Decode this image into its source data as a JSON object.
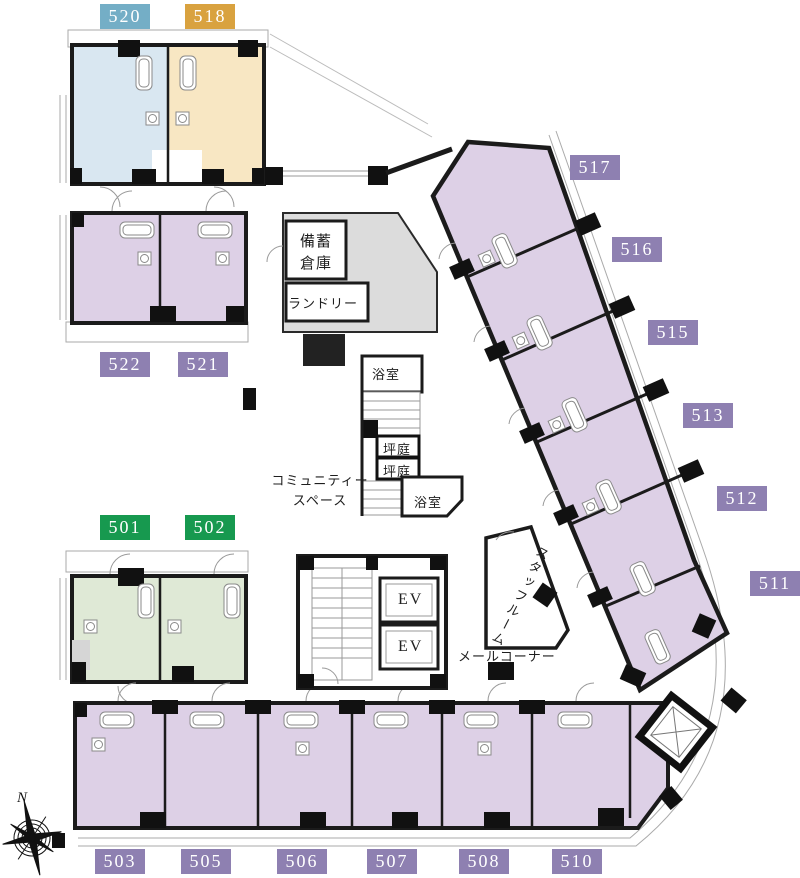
{
  "palette": {
    "blue": "#74aec6",
    "orange": "#d9a23f",
    "purple": "#8e80b1",
    "green": "#17994f",
    "room_blue": "#d9e7f1",
    "room_orange": "#f8e7c3",
    "room_purple": "#ddd0e6",
    "room_green": "#dfe9d6",
    "common_gray": "#dcdcdc",
    "wall": "#1b1b1b"
  },
  "badges": [
    {
      "label": "520",
      "color": "blue"
    },
    {
      "label": "518",
      "color": "orange"
    },
    {
      "label": "522",
      "color": "purple"
    },
    {
      "label": "521",
      "color": "purple"
    },
    {
      "label": "501",
      "color": "green"
    },
    {
      "label": "502",
      "color": "green"
    },
    {
      "label": "517",
      "color": "purple"
    },
    {
      "label": "516",
      "color": "purple"
    },
    {
      "label": "515",
      "color": "purple"
    },
    {
      "label": "513",
      "color": "purple"
    },
    {
      "label": "512",
      "color": "purple"
    },
    {
      "label": "511",
      "color": "purple"
    },
    {
      "label": "503",
      "color": "purple"
    },
    {
      "label": "505",
      "color": "purple"
    },
    {
      "label": "506",
      "color": "purple"
    },
    {
      "label": "507",
      "color": "purple"
    },
    {
      "label": "508",
      "color": "purple"
    },
    {
      "label": "510",
      "color": "purple"
    }
  ],
  "labels": {
    "storage_l1": "備蓄",
    "storage_l2": "倉庫",
    "laundry": "ランドリー",
    "bath": "浴室",
    "courtyard": "坪庭",
    "community_l1": "コミュニティー",
    "community_l2": "スペース",
    "staff_room": "スタッフルーム",
    "mail_corner": "メールコーナー",
    "elevator": "EV",
    "north": "N"
  }
}
